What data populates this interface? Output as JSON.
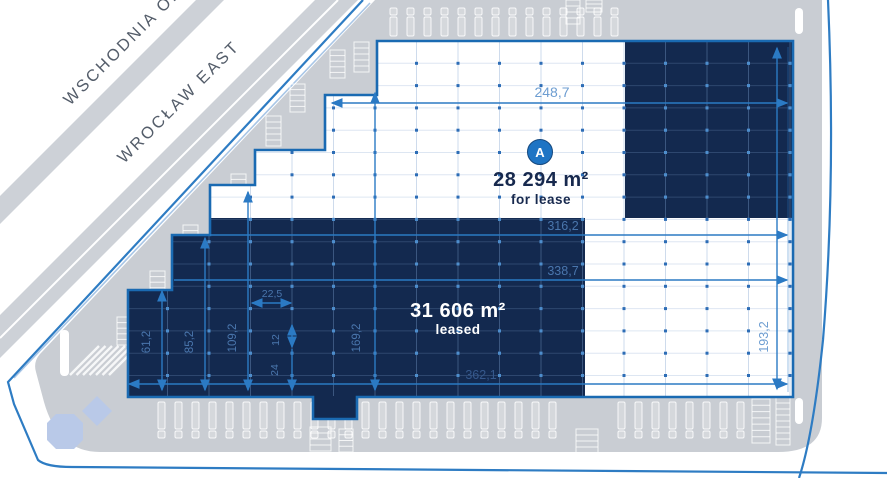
{
  "site": {
    "road_labels": [
      "WSCHODNIA OB",
      "WROCŁAW EAST"
    ],
    "units": {
      "for_lease": {
        "marker": "A",
        "area": "28 294 m²",
        "status": "for lease"
      },
      "leased": {
        "area": "31 606 m²",
        "status": "leased"
      }
    },
    "dimensions": {
      "top_width": "248,7",
      "upper_width": "316,2",
      "mid_width": "338,7",
      "bottom_width": "362,1",
      "right_height": "193,2",
      "col1": "61,2",
      "col2": "85,2",
      "col3": "109,2",
      "col4": "169,2",
      "bay_width": "22,5",
      "bay_h1": "12",
      "bay_h2": "24"
    }
  },
  "colors": {
    "navy": "#13294f",
    "outline_blue": "#1a6ab2",
    "dimension_blue": "#2b7ac4",
    "boundary_blue": "#2e7cc3",
    "road_gray": "#cdd1d7",
    "yard_gray": "#c9cdd3",
    "marker_blue": "#1e74c4",
    "pond_blue": "#b9c9e8",
    "label_navy": "#17294e",
    "dot_on_white": "#2d6db6",
    "dot_on_navy": "#4e8ecd",
    "dim_label_light": "#6d9dd1",
    "dim_label_navy": "#4a76ad",
    "dim_label_dark": "#35588c"
  }
}
